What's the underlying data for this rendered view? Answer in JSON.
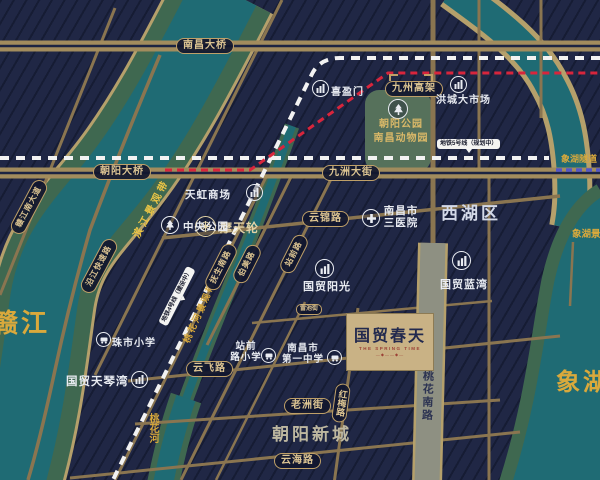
{
  "colors": {
    "navy": "#1c2442",
    "gold_text": "#d9a93c",
    "pill_gold": "#dcc492",
    "teal_water": "#1f6b74",
    "olive_bank": "#3f6850",
    "road_tan": "#8a7550",
    "road_major": "#a28c5d",
    "road_gray": "#8e9082",
    "park_green": "#56715b",
    "metro_white": "#f2f2f2",
    "viaduct_red": "#d8253c",
    "tunnel_purple": "#5456c8",
    "belt_yellow": "#ecc545"
  },
  "waters": {
    "ganjiang": "赣江",
    "taohua_river": "桃花河",
    "xianghu": "象湖"
  },
  "belts": {
    "binjiang": "滨江景观带",
    "taohua": "桃花河景观带",
    "xianghu": "象湖景观带"
  },
  "districts": {
    "xihu": "西湖区",
    "chaoyang_newtown": "朝阳新城"
  },
  "roads": {
    "nanchang_bridge": "南昌大桥",
    "chaoyang_bridge": "朝阳大桥",
    "jiuzhou_viaduct": "九州高架",
    "jiuzhou_street": "九洲大街",
    "yunjin": "云锦路",
    "yunfei": "云飞路",
    "yunhai": "云海路",
    "laozhou": "老洲街",
    "leichi": "雷池街",
    "hongmei": "红梅路",
    "taohua_south": "桃花南路",
    "fusheng_south": "抚生南路",
    "bomei": "伯美路",
    "zhanqian": "站前路",
    "ganjiang_south_ave": "赣江南大道",
    "yanjiang_express": "沿江快速路",
    "xianghu_tunnel": "象湖隧道"
  },
  "metro": {
    "line5": "地铁5号线（规划中）",
    "line4": "地铁4号线（建设中）"
  },
  "pois": {
    "ferris_wheel": {
      "label": "摩天轮"
    },
    "tianhong_mall": {
      "label": "天虹商场"
    },
    "central_park": {
      "label": "中央公园"
    },
    "xiyingmen": {
      "label": "喜盈门"
    },
    "hongcheng_market": {
      "label": "洪城大市场"
    },
    "chaoyang_park": {
      "line1": "朝阳公园",
      "line2": "南昌动物园"
    },
    "third_hospital": {
      "line1": "南昌市",
      "line2": "三医院"
    },
    "guomao_sunshine": {
      "label": "国贸阳光"
    },
    "guomao_bluebay": {
      "label": "国贸蓝湾"
    },
    "zhushi_school": {
      "label": "珠市小学"
    },
    "guomao_tianqinbay": {
      "label": "国贸天琴湾"
    },
    "zhanqian_school": {
      "line1": "站前",
      "line2": "路小学"
    },
    "no1_middle_school": {
      "line1": "南昌市",
      "line2": "第一中学"
    }
  },
  "project": {
    "name": "国贸春天",
    "tagline_en": "THE SPRING TIME",
    "deco": "—◆——◆—"
  }
}
